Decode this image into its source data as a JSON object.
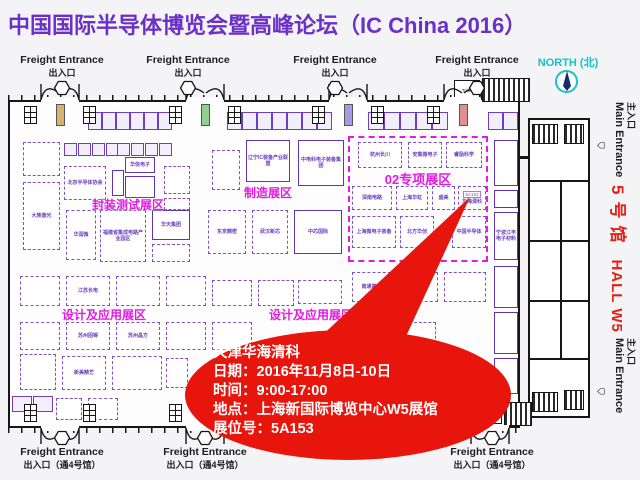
{
  "title": "中国国际半导体博览会暨高峰论坛（IC China 2016）",
  "colors": {
    "title": "#6a30c8",
    "zone": "#e21ae2",
    "booth": "#6a3fc0",
    "callout_red": "#e8150c",
    "hall_red": "#e32117",
    "north_cyan": "#12c4c8"
  },
  "callout": {
    "lines": [
      "天津华海清科",
      "日期：2016年11月8日-10日",
      "时间：9:00-17:00",
      "地点：上海新国际博览中心W5展馆",
      "展位号：5A153"
    ]
  },
  "right_margin": {
    "north_label": "NORTH (北)",
    "compass_icon": "compass-icon",
    "main_entrance_en": "Main Entrance",
    "main_entrance_zh": "主入口",
    "hall_label_cn": "5号馆",
    "hall_label_en": "HALL W5"
  },
  "map": {
    "freight_top": {
      "label1": "Freight Entrance",
      "label2": "出入口",
      "items": [
        {
          "label_cx": 62,
          "door_cx": 60,
          "elev": "#d8b274"
        },
        {
          "label_cx": 188,
          "door_cx": 205,
          "elev": "#8fcf8f"
        },
        {
          "label_cx": 335,
          "door_cx": 348,
          "elev": "#a89ae0"
        },
        {
          "label_cx": 477,
          "door_cx": 463,
          "elev": "#e09090"
        }
      ]
    },
    "freight_bottom": {
      "label1": "Freight Entrance",
      "label2": "出入口（通4号馆）",
      "items": [
        {
          "label_cx": 62,
          "door_cx": 60
        },
        {
          "label_cx": 205,
          "door_cx": 205
        },
        {
          "label_cx": 492,
          "door_cx": 490
        }
      ]
    },
    "zones": [
      {
        "text": "封装测试展区",
        "cx": 128,
        "y": 196,
        "fs": 12
      },
      {
        "text": "制造展区",
        "cx": 268,
        "y": 184,
        "fs": 12
      },
      {
        "text": "02专项展区",
        "cx": 418,
        "y": 169,
        "fs": 13
      },
      {
        "text": "设计及应用展区",
        "cx": 104,
        "y": 306,
        "fs": 12
      },
      {
        "text": "设计及应用展区",
        "cx": 311,
        "y": 306,
        "fs": 12
      }
    ],
    "zone_rect": {
      "x": 348,
      "y": 136,
      "w": 140,
      "h": 126
    },
    "arrow_points": "470,197 300,356 397,356",
    "booths": [
      [
        88,
        112,
        14,
        18,
        "t"
      ],
      [
        102,
        112,
        14,
        18,
        "t"
      ],
      [
        116,
        112,
        14,
        18,
        "t"
      ],
      [
        130,
        112,
        14,
        18,
        "t"
      ],
      [
        144,
        112,
        14,
        18,
        "t"
      ],
      [
        158,
        112,
        14,
        18,
        "t"
      ],
      [
        227,
        112,
        15,
        18,
        "t"
      ],
      [
        242,
        112,
        15,
        18,
        "t"
      ],
      [
        257,
        112,
        15,
        18,
        "t"
      ],
      [
        272,
        112,
        15,
        18,
        "t"
      ],
      [
        287,
        112,
        15,
        18,
        "t"
      ],
      [
        302,
        112,
        15,
        18,
        "t"
      ],
      [
        317,
        112,
        15,
        18,
        "t"
      ],
      [
        368,
        112,
        16,
        18,
        "t"
      ],
      [
        384,
        112,
        16,
        18,
        "t"
      ],
      [
        400,
        112,
        16,
        18,
        "t"
      ],
      [
        416,
        112,
        16,
        18,
        "t"
      ],
      [
        432,
        112,
        16,
        18,
        "t"
      ],
      [
        488,
        112,
        15,
        18,
        "t"
      ],
      [
        503,
        112,
        15,
        18,
        "t"
      ],
      [
        23,
        142,
        37,
        34,
        "d"
      ],
      [
        23,
        182,
        37,
        68,
        "d",
        "大族激光"
      ],
      [
        64,
        143,
        13,
        13,
        "t"
      ],
      [
        78,
        143,
        13,
        13,
        "t"
      ],
      [
        92,
        143,
        13,
        13,
        "t"
      ],
      [
        106,
        143,
        13,
        13,
        "t"
      ],
      [
        117,
        143,
        13,
        13,
        "t"
      ],
      [
        131,
        143,
        13,
        13,
        "t"
      ],
      [
        145,
        143,
        13,
        13,
        "t"
      ],
      [
        159,
        143,
        13,
        13,
        "t"
      ],
      [
        112,
        170,
        12,
        26,
        "s"
      ],
      [
        64,
        166,
        42,
        34,
        "d",
        "北京半导体协会"
      ],
      [
        125,
        157,
        30,
        16,
        "s",
        "华信电子"
      ],
      [
        125,
        176,
        30,
        22,
        "s"
      ],
      [
        164,
        166,
        26,
        28,
        "d"
      ],
      [
        164,
        198,
        26,
        12,
        "d"
      ],
      [
        212,
        150,
        28,
        40,
        "d"
      ],
      [
        246,
        140,
        44,
        42,
        "s",
        "辽宁IC装备产业联盟"
      ],
      [
        298,
        140,
        46,
        46,
        "s",
        "中电科电子装备集团"
      ],
      [
        358,
        142,
        44,
        26,
        "d",
        "杭州长川"
      ],
      [
        408,
        142,
        34,
        26,
        "d",
        "安集微电子"
      ],
      [
        446,
        142,
        36,
        26,
        "d",
        "睿励科学"
      ],
      [
        352,
        186,
        40,
        24,
        "d",
        "深南电路"
      ],
      [
        396,
        186,
        32,
        24,
        "d",
        "上海华虹"
      ],
      [
        432,
        186,
        23,
        24,
        "d",
        "盛美"
      ],
      [
        458,
        186,
        28,
        24,
        "d",
        "华海清科",
        "5A153"
      ],
      [
        352,
        216,
        44,
        32,
        "d",
        "上海微电子装备"
      ],
      [
        400,
        216,
        34,
        32,
        "d",
        "北方华创"
      ],
      [
        452,
        216,
        34,
        32,
        "d",
        "中国半导体"
      ],
      [
        66,
        210,
        30,
        50,
        "d",
        "华润微"
      ],
      [
        100,
        210,
        46,
        52,
        "d",
        "福建省集成电路产业园区"
      ],
      [
        152,
        210,
        38,
        30,
        "s",
        "华天集团"
      ],
      [
        152,
        244,
        38,
        18,
        "d"
      ],
      [
        208,
        210,
        38,
        44,
        "d",
        "东京精密"
      ],
      [
        252,
        210,
        36,
        44,
        "d",
        "武汉新芯"
      ],
      [
        294,
        210,
        48,
        44,
        "s",
        "中芯国际"
      ],
      [
        494,
        140,
        24,
        46,
        "s"
      ],
      [
        494,
        190,
        24,
        18,
        "s"
      ],
      [
        494,
        212,
        24,
        48,
        "s",
        "宁波江丰电子材料"
      ],
      [
        494,
        266,
        24,
        42,
        "s"
      ],
      [
        494,
        312,
        24,
        42,
        "s"
      ],
      [
        494,
        358,
        24,
        36,
        "s"
      ],
      [
        20,
        276,
        40,
        30,
        "d"
      ],
      [
        66,
        276,
        44,
        30,
        "d",
        "江苏长电"
      ],
      [
        116,
        276,
        44,
        30,
        "d"
      ],
      [
        166,
        276,
        40,
        30,
        "d"
      ],
      [
        212,
        280,
        40,
        26,
        "d"
      ],
      [
        258,
        280,
        36,
        26,
        "d"
      ],
      [
        298,
        280,
        44,
        24,
        "d"
      ],
      [
        352,
        272,
        44,
        30,
        "d",
        "南通富士通"
      ],
      [
        404,
        272,
        34,
        30,
        "d"
      ],
      [
        444,
        272,
        42,
        30,
        "d"
      ],
      [
        20,
        322,
        40,
        28,
        "d"
      ],
      [
        66,
        322,
        44,
        28,
        "d",
        "苏州固锝"
      ],
      [
        116,
        322,
        44,
        28,
        "d",
        "苏州晶方"
      ],
      [
        166,
        322,
        40,
        28,
        "d"
      ],
      [
        212,
        322,
        40,
        28,
        "d"
      ],
      [
        352,
        322,
        42,
        26,
        "d"
      ],
      [
        400,
        322,
        36,
        26,
        "d"
      ],
      [
        20,
        354,
        36,
        36,
        "d"
      ],
      [
        62,
        356,
        44,
        34,
        "d",
        "新美精艺"
      ],
      [
        112,
        356,
        50,
        34,
        "d"
      ],
      [
        166,
        358,
        22,
        30,
        "d"
      ],
      [
        12,
        396,
        20,
        16,
        "t"
      ],
      [
        33,
        396,
        20,
        16,
        "t"
      ],
      [
        56,
        398,
        26,
        22,
        "d"
      ],
      [
        88,
        398,
        30,
        22,
        "d"
      ],
      [
        24,
        106,
        13,
        18,
        "w"
      ],
      [
        83,
        106,
        13,
        18,
        "w"
      ],
      [
        169,
        106,
        13,
        18,
        "w"
      ],
      [
        228,
        106,
        13,
        18,
        "w"
      ],
      [
        312,
        106,
        13,
        18,
        "w"
      ],
      [
        371,
        106,
        13,
        18,
        "w"
      ],
      [
        427,
        106,
        13,
        18,
        "w"
      ],
      [
        24,
        404,
        13,
        18,
        "w"
      ],
      [
        83,
        404,
        13,
        18,
        "w"
      ],
      [
        169,
        404,
        13,
        18,
        "w"
      ],
      [
        228,
        404,
        13,
        18,
        "w"
      ]
    ],
    "blocks": {
      "toilet_label": "Toilet",
      "top": {
        "cell": [
          454,
          80,
          26,
          20
        ],
        "hatch": [
          482,
          78,
          48,
          24
        ]
      },
      "bottom": {
        "cell": [
          478,
          404,
          24,
          20
        ],
        "hatch": [
          504,
          402,
          28,
          24
        ]
      }
    }
  }
}
